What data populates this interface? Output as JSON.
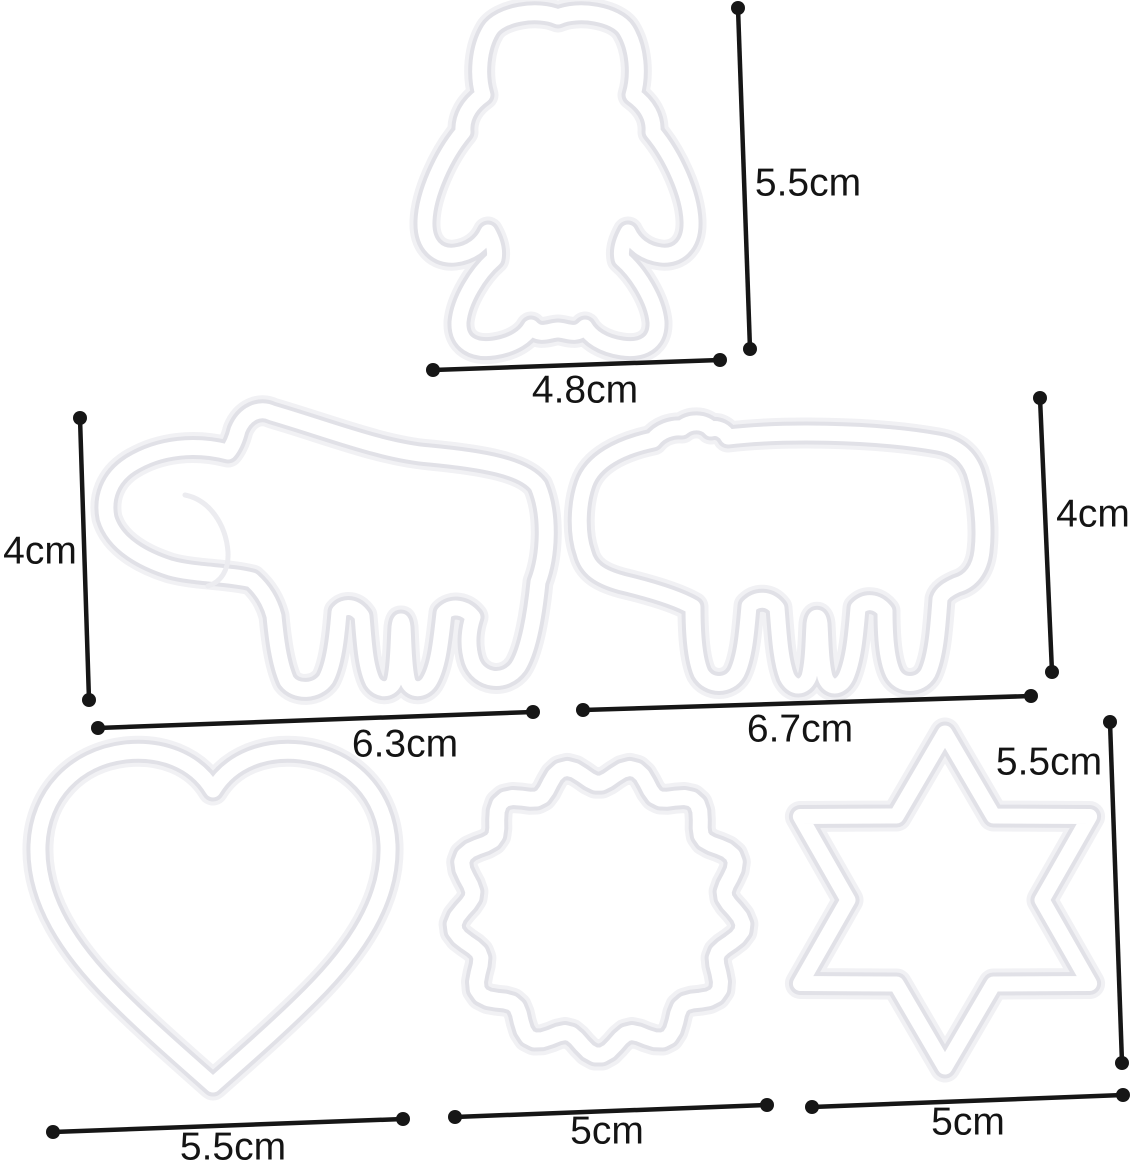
{
  "figure": {
    "description": "dimension diagram of six white plastic cookie cutters",
    "colors": {
      "background": "#ffffff",
      "dimension_line": "#161616",
      "cutter_fill": "#ffffff",
      "cutter_edge": "#e1e1e7"
    },
    "shapes": [
      {
        "id": "bear",
        "icon": "teddy-bear-outline",
        "height": "5.5cm",
        "width": "4.8cm"
      },
      {
        "id": "elephant",
        "icon": "elephant-outline",
        "height": "4cm",
        "width": "6.3cm"
      },
      {
        "id": "rhino",
        "icon": "rhino-outline",
        "height": "4cm",
        "width": "6.7cm"
      },
      {
        "id": "heart",
        "icon": "heart-outline",
        "width": "5.5cm"
      },
      {
        "id": "scalloped-circle",
        "icon": "scalloped-circle-outline",
        "width": "5cm"
      },
      {
        "id": "six-point-star",
        "icon": "six-point-star-outline",
        "height": "5.5cm",
        "width": "5cm"
      }
    ]
  },
  "measurements": {
    "bear_height": "5.5cm",
    "bear_width": "4.8cm",
    "elephant_height": "4cm",
    "elephant_width": "6.3cm",
    "rhino_height": "4cm",
    "rhino_width": "6.7cm",
    "star_height": "5.5cm",
    "heart_width": "5.5cm",
    "circle_width": "5cm",
    "star_width": "5cm"
  }
}
